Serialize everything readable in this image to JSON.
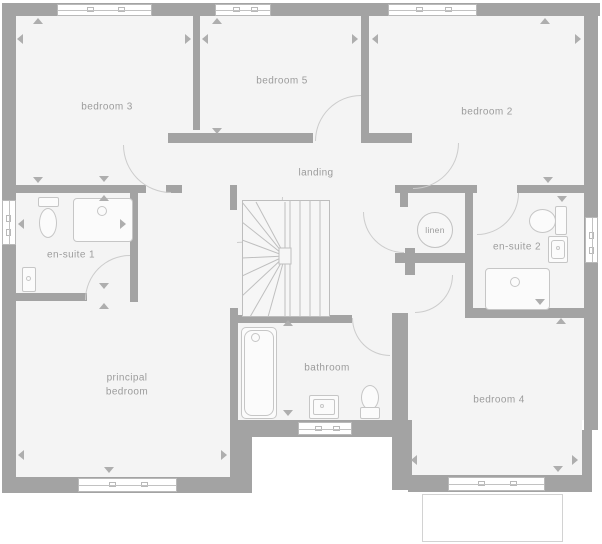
{
  "rooms": {
    "bedroom3": {
      "label": "bedroom 3"
    },
    "bedroom5": {
      "label": "bedroom 5"
    },
    "bedroom2": {
      "label": "bedroom 2"
    },
    "landing": {
      "label": "landing"
    },
    "linen": {
      "label": "linen"
    },
    "ensuite1": {
      "label": "en-suite 1"
    },
    "ensuite2": {
      "label": "en-suite 2"
    },
    "principal": {
      "label": "principal bedroom"
    },
    "bathroom": {
      "label": "bathroom"
    },
    "bedroom4": {
      "label": "bedroom 4"
    }
  },
  "fixtures": {
    "ensuite1": [
      "toilet",
      "shower-tray",
      "wash-basin"
    ],
    "ensuite2": [
      "toilet",
      "wash-basin",
      "shower-tray"
    ],
    "bathroom": [
      "bathtub",
      "wash-basin",
      "toilet"
    ],
    "stairs": "winder-staircase",
    "storage": "linen-cupboard"
  },
  "colors": {
    "wall": "#a3a3a3",
    "floor": "#f4f4f4",
    "fixture_line": "#c6c6c6",
    "door_swing": "#cccccc",
    "label_text": "#9c9c9c",
    "background": "#ffffff"
  }
}
